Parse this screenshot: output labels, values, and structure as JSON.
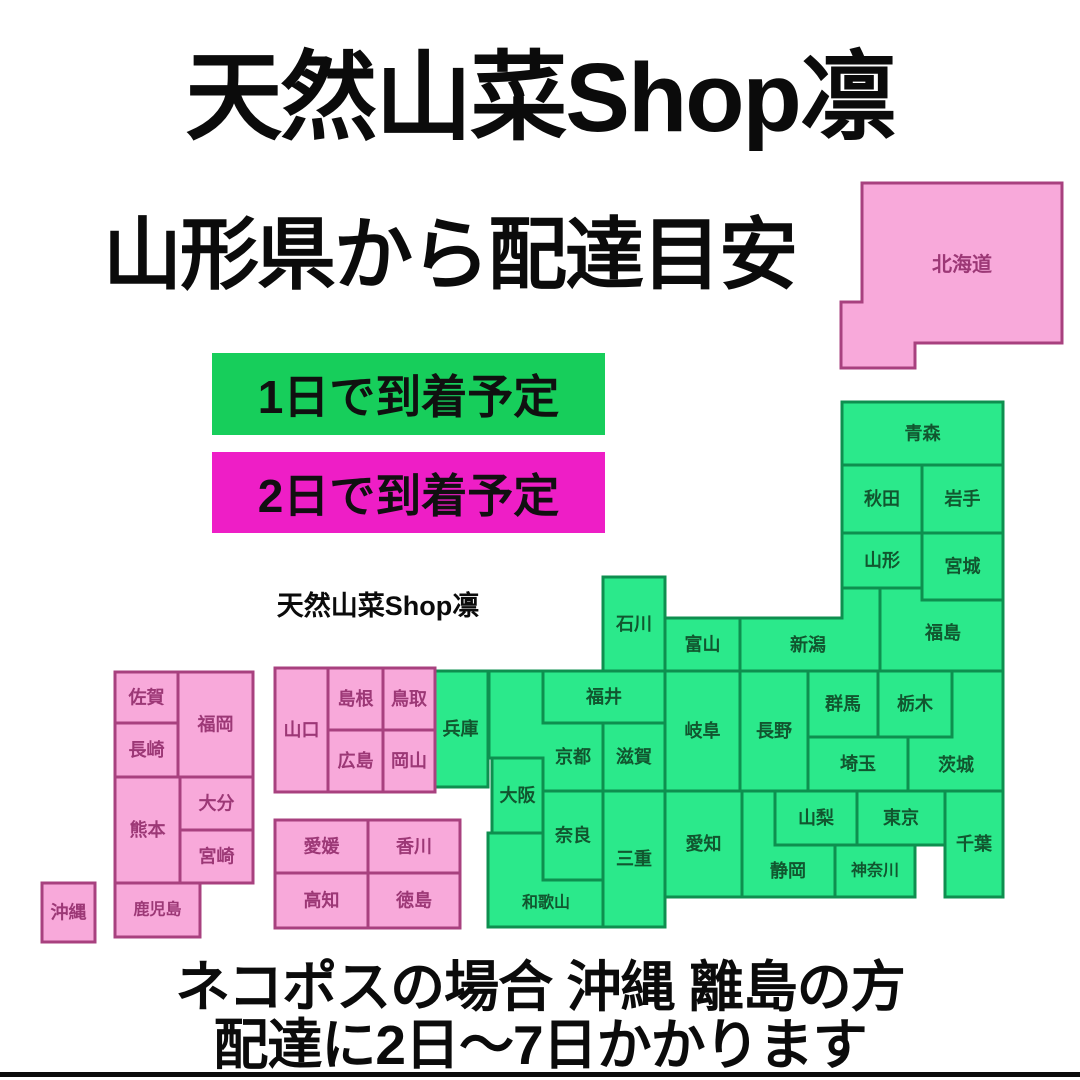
{
  "header": {
    "title": "天然山菜Shop凛",
    "subtitle": "山形県から配達目安"
  },
  "brand_small": "天然山菜Shop凛",
  "legend": {
    "items": [
      {
        "label": "1日で到着予定",
        "color": "#17CE5B"
      },
      {
        "label": "2日で到着予定",
        "color": "#EE1EC6"
      }
    ]
  },
  "footer": {
    "line1": "ネコポスの場合 沖縄 離島の方",
    "line2": "配達に2日〜7日かかります"
  },
  "map": {
    "origin_note": "shipping origin is Yamagata prefecture",
    "styles": {
      "one_day": {
        "fill": "#2BE98B",
        "stroke": "#0E8F4F",
        "text": "#11562F"
      },
      "two_day": {
        "fill": "#F8A9DA",
        "stroke": "#A8417F",
        "text": "#9C3876"
      }
    },
    "prefectures": [
      {
        "id": "hokkaido",
        "label": "北海道",
        "delivery": "two_day",
        "points": [
          [
            862,
            183
          ],
          [
            1062,
            183
          ],
          [
            1062,
            343
          ],
          [
            915,
            343
          ],
          [
            915,
            368
          ],
          [
            841,
            368
          ],
          [
            841,
            302
          ],
          [
            862,
            302
          ]
        ],
        "label_x": 962,
        "label_y": 265,
        "font": 20
      },
      {
        "id": "aomori",
        "label": "青森",
        "delivery": "one_day",
        "rect": [
          842,
          402,
          161,
          63
        ]
      },
      {
        "id": "akita",
        "label": "秋田",
        "delivery": "one_day",
        "rect": [
          842,
          465,
          80,
          68
        ]
      },
      {
        "id": "iwate",
        "label": "岩手",
        "delivery": "one_day",
        "rect": [
          922,
          465,
          81,
          68
        ]
      },
      {
        "id": "yamagata",
        "label": "山形",
        "delivery": "one_day",
        "rect": [
          842,
          533,
          80,
          55
        ]
      },
      {
        "id": "miyagi",
        "label": "宮城",
        "delivery": "one_day",
        "rect": [
          922,
          533,
          81,
          67
        ]
      },
      {
        "id": "fukushima",
        "label": "福島",
        "delivery": "one_day",
        "points": [
          [
            880,
            588
          ],
          [
            922,
            588
          ],
          [
            922,
            600
          ],
          [
            1003,
            600
          ],
          [
            1003,
            671
          ],
          [
            880,
            671
          ]
        ],
        "label_x": 943,
        "label_y": 633
      },
      {
        "id": "niigata",
        "label": "新潟",
        "delivery": "one_day",
        "points": [
          [
            740,
            618
          ],
          [
            842,
            618
          ],
          [
            842,
            588
          ],
          [
            880,
            588
          ],
          [
            880,
            671
          ],
          [
            740,
            671
          ]
        ],
        "label_x": 808,
        "label_y": 645
      },
      {
        "id": "toyama",
        "label": "富山",
        "delivery": "one_day",
        "rect": [
          665,
          618,
          75,
          53
        ]
      },
      {
        "id": "ishikawa",
        "label": "石川",
        "delivery": "one_day",
        "rect": [
          603,
          577,
          62,
          94
        ]
      },
      {
        "id": "fukui",
        "label": "福井",
        "delivery": "one_day",
        "rect": [
          543,
          671,
          122,
          52
        ]
      },
      {
        "id": "nagano",
        "label": "長野",
        "delivery": "one_day",
        "rect": [
          740,
          671,
          68,
          120
        ]
      },
      {
        "id": "gifu",
        "label": "岐阜",
        "delivery": "one_day",
        "rect": [
          665,
          671,
          75,
          120
        ]
      },
      {
        "id": "gunma",
        "label": "群馬",
        "delivery": "one_day",
        "rect": [
          808,
          671,
          70,
          66
        ]
      },
      {
        "id": "tochigi",
        "label": "栃木",
        "delivery": "one_day",
        "rect": [
          878,
          671,
          74,
          66
        ]
      },
      {
        "id": "ibaraki",
        "label": "茨城",
        "delivery": "one_day",
        "points": [
          [
            952,
            671
          ],
          [
            1003,
            671
          ],
          [
            1003,
            791
          ],
          [
            908,
            791
          ],
          [
            908,
            737
          ],
          [
            952,
            737
          ]
        ],
        "label_x": 956,
        "label_y": 765
      },
      {
        "id": "saitama",
        "label": "埼玉",
        "delivery": "one_day",
        "rect": [
          808,
          737,
          100,
          54
        ]
      },
      {
        "id": "chiba",
        "label": "千葉",
        "delivery": "one_day",
        "rect": [
          945,
          791,
          58,
          106
        ]
      },
      {
        "id": "tokyo",
        "label": "東京",
        "delivery": "one_day",
        "rect": [
          857,
          791,
          88,
          54
        ]
      },
      {
        "id": "yamanashi",
        "label": "山梨",
        "delivery": "one_day",
        "rect": [
          775,
          791,
          82,
          54
        ]
      },
      {
        "id": "kanagawa",
        "label": "神奈川",
        "delivery": "one_day",
        "rect": [
          835,
          845,
          80,
          52
        ],
        "font": 16
      },
      {
        "id": "shizuoka",
        "label": "静岡",
        "delivery": "one_day",
        "points": [
          [
            742,
            791
          ],
          [
            775,
            791
          ],
          [
            775,
            845
          ],
          [
            835,
            845
          ],
          [
            835,
            897
          ],
          [
            742,
            897
          ]
        ],
        "label_x": 788,
        "label_y": 871
      },
      {
        "id": "aichi",
        "label": "愛知",
        "delivery": "one_day",
        "rect": [
          665,
          791,
          77,
          106
        ]
      },
      {
        "id": "mie",
        "label": "三重",
        "delivery": "one_day",
        "rect": [
          603,
          791,
          62,
          136
        ]
      },
      {
        "id": "shiga",
        "label": "滋賀",
        "delivery": "one_day",
        "rect": [
          603,
          723,
          62,
          68
        ]
      },
      {
        "id": "kyoto",
        "label": "京都",
        "delivery": "one_day",
        "points": [
          [
            489,
            671
          ],
          [
            543,
            671
          ],
          [
            543,
            723
          ],
          [
            603,
            723
          ],
          [
            603,
            791
          ],
          [
            543,
            791
          ],
          [
            543,
            758
          ],
          [
            489,
            758
          ]
        ],
        "label_x": 573,
        "label_y": 757
      },
      {
        "id": "osaka",
        "label": "大阪",
        "delivery": "one_day",
        "rect": [
          492,
          758,
          51,
          75
        ]
      },
      {
        "id": "hyogo",
        "label": "兵庫",
        "delivery": "one_day",
        "rect": [
          433,
          671,
          55,
          116
        ]
      },
      {
        "id": "nara",
        "label": "奈良",
        "delivery": "one_day",
        "rect": [
          543,
          791,
          60,
          89
        ]
      },
      {
        "id": "wakayama",
        "label": "和歌山",
        "delivery": "one_day",
        "points": [
          [
            488,
            833
          ],
          [
            543,
            833
          ],
          [
            543,
            880
          ],
          [
            603,
            880
          ],
          [
            603,
            927
          ],
          [
            488,
            927
          ]
        ],
        "label_x": 546,
        "label_y": 903,
        "font": 16
      },
      {
        "id": "tottori",
        "label": "鳥取",
        "delivery": "two_day",
        "rect": [
          383,
          668,
          52,
          62
        ]
      },
      {
        "id": "shimane",
        "label": "島根",
        "delivery": "two_day",
        "rect": [
          328,
          668,
          55,
          62
        ]
      },
      {
        "id": "okayama",
        "label": "岡山",
        "delivery": "two_day",
        "rect": [
          383,
          730,
          52,
          62
        ]
      },
      {
        "id": "hiroshima",
        "label": "広島",
        "delivery": "two_day",
        "rect": [
          328,
          730,
          55,
          62
        ]
      },
      {
        "id": "yamaguchi",
        "label": "山口",
        "delivery": "two_day",
        "rect": [
          275,
          668,
          53,
          124
        ]
      },
      {
        "id": "kagawa",
        "label": "香川",
        "delivery": "two_day",
        "rect": [
          368,
          820,
          92,
          53
        ]
      },
      {
        "id": "ehime",
        "label": "愛媛",
        "delivery": "two_day",
        "rect": [
          275,
          820,
          93,
          53
        ]
      },
      {
        "id": "kochi",
        "label": "高知",
        "delivery": "two_day",
        "rect": [
          275,
          873,
          93,
          55
        ]
      },
      {
        "id": "tokushima",
        "label": "徳島",
        "delivery": "two_day",
        "rect": [
          368,
          873,
          92,
          55
        ]
      },
      {
        "id": "fukuoka",
        "label": "福岡",
        "delivery": "two_day",
        "rect": [
          178,
          672,
          75,
          105
        ]
      },
      {
        "id": "saga",
        "label": "佐賀",
        "delivery": "two_day",
        "rect": [
          115,
          672,
          63,
          51
        ]
      },
      {
        "id": "nagasaki",
        "label": "長崎",
        "delivery": "two_day",
        "rect": [
          115,
          723,
          63,
          54
        ]
      },
      {
        "id": "kumamoto",
        "label": "熊本",
        "delivery": "two_day",
        "rect": [
          115,
          777,
          65,
          106
        ]
      },
      {
        "id": "oita",
        "label": "大分",
        "delivery": "two_day",
        "rect": [
          180,
          777,
          73,
          53
        ]
      },
      {
        "id": "miyazaki",
        "label": "宮崎",
        "delivery": "two_day",
        "rect": [
          180,
          830,
          73,
          53
        ]
      },
      {
        "id": "kagoshima",
        "label": "鹿児島",
        "delivery": "two_day",
        "rect": [
          115,
          883,
          85,
          54
        ],
        "font": 16
      },
      {
        "id": "okinawa",
        "label": "沖縄",
        "delivery": "two_day",
        "rect": [
          42,
          883,
          53,
          59
        ]
      }
    ]
  }
}
